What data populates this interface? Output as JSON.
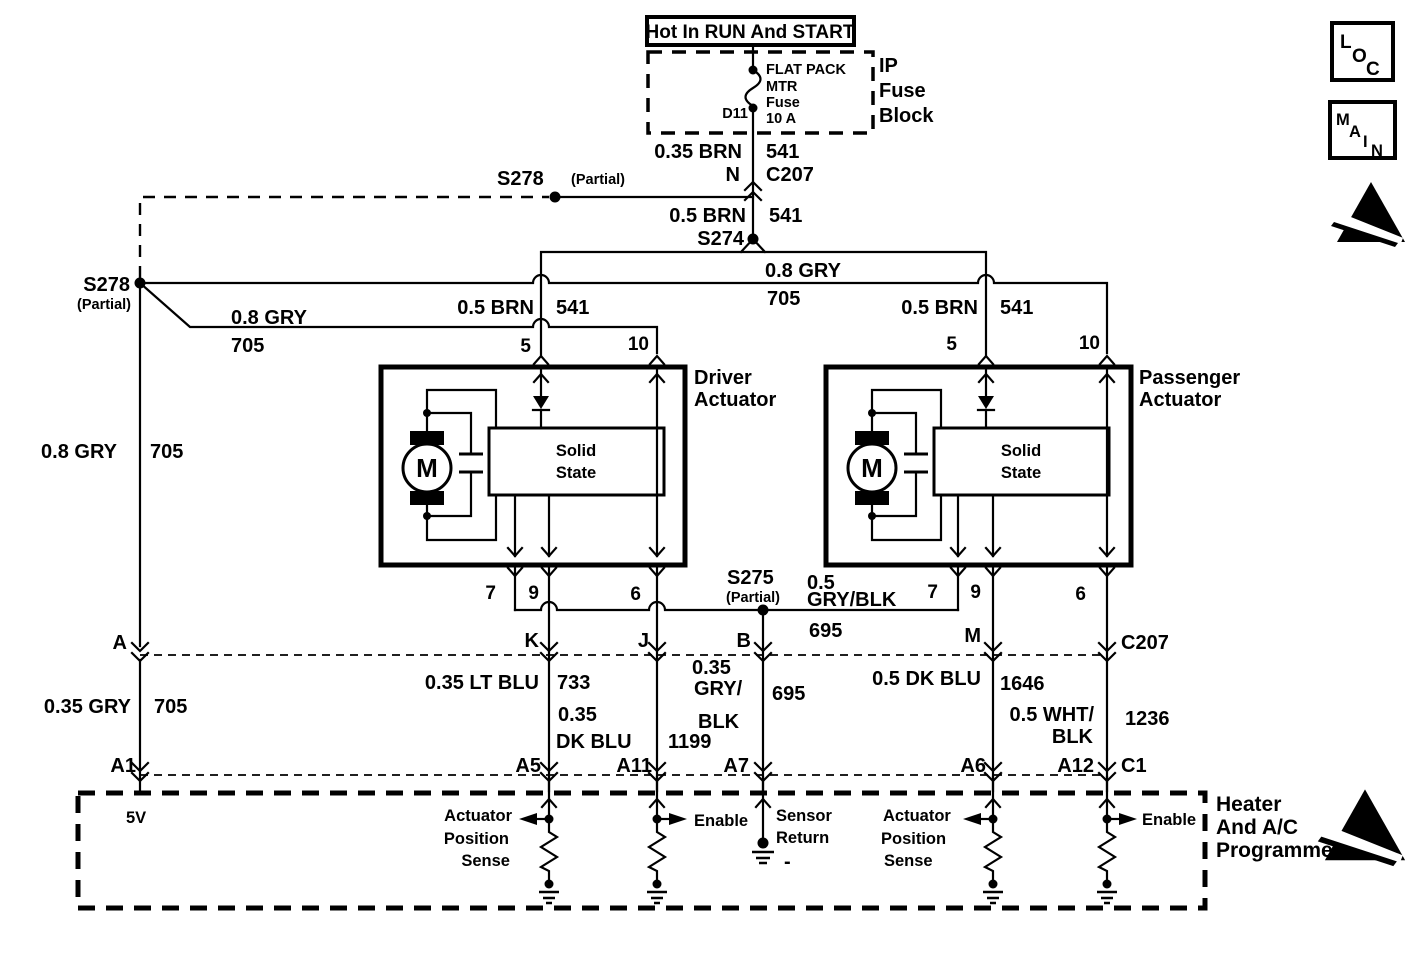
{
  "power": {
    "hot_label": "Hot In RUN And START",
    "fuse_name_1": "FLAT PACK",
    "fuse_name_2": "MTR",
    "fuse_name_3": "Fuse",
    "fuse_name_4": "10 A",
    "fuse_terminal": "D11",
    "block_name_1": "IP",
    "block_name_2": "Fuse",
    "block_name_3": "Block"
  },
  "corner_icons": {
    "loc_letters": [
      "L",
      "O",
      "C"
    ],
    "main_letters": [
      "M",
      "A",
      "I",
      "N"
    ]
  },
  "wires": {
    "fuse_output_color": "0.35 BRN",
    "fuse_output_terminal": "N",
    "fuse_output_circuit": "541",
    "fuse_output_connector": "C207",
    "feed_color": "0.5 BRN",
    "feed_circuit": "541",
    "gry_top_color": "0.8 GRY",
    "gry_top_circuit": "705",
    "gry_branch_color": "0.8 GRY",
    "gry_branch_circuit": "705",
    "brn_driver_color": "0.5 BRN",
    "brn_driver_circuit": "541",
    "brn_pass_color": "0.5 BRN",
    "brn_pass_circuit": "541",
    "gry_left_color": "0.8 GRY",
    "gry_left_circuit": "705",
    "gry_lower_color": "0.35 GRY",
    "gry_lower_circuit": "705",
    "bus_color_1": "0.5",
    "bus_color_2": "GRY/BLK",
    "bus_circuit": "695",
    "k_color": "0.35 LT BLU",
    "k_circuit": "733",
    "j_color_1": "0.35",
    "j_color_2": "DK BLU",
    "j_circuit": "1199",
    "b_color_1": "0.35",
    "b_color_2": "GRY/",
    "b_color_3": "BLK",
    "b_circuit": "695",
    "m_color": "0.5 DK BLU",
    "m_circuit": "1646",
    "right_color_1": "0.5 WHT/",
    "right_color_2": "BLK",
    "right_circuit": "1236"
  },
  "splices": {
    "s274": "S274",
    "s278_top_name": "S278",
    "s278_top_partial": "(Partial)",
    "s278_left_name": "S278",
    "s278_left_partial": "(Partial)",
    "s275_name": "S275",
    "s275_partial": "(Partial)"
  },
  "driver_actuator": {
    "name_1": "Driver",
    "name_2": "Actuator",
    "motor": "M",
    "solid_1": "Solid",
    "solid_2": "State",
    "pin_5": "5",
    "pin_10": "10",
    "pin_7": "7",
    "pin_9": "9",
    "pin_6": "6"
  },
  "passenger_actuator": {
    "name_1": "Passenger",
    "name_2": "Actuator",
    "motor": "M",
    "solid_1": "Solid",
    "solid_2": "State",
    "pin_5": "5",
    "pin_10": "10",
    "pin_7": "7",
    "pin_9": "9",
    "pin_6": "6"
  },
  "connector_row": {
    "t_a": "A",
    "t_k": "K",
    "t_j": "J",
    "t_b": "B",
    "t_m": "M",
    "name": "C207"
  },
  "programmer_row": {
    "t_a1": "A1",
    "t_a5": "A5",
    "t_a11": "A11",
    "t_a7": "A7",
    "t_a6": "A6",
    "t_a12": "A12",
    "name": "C1"
  },
  "programmer": {
    "name_1": "Heater",
    "name_2": "And A/C",
    "name_3": "Programmer",
    "ref": "5V",
    "drv_sense_1": "Actuator",
    "drv_sense_2": "Position",
    "drv_sense_3": "Sense",
    "drv_enable": "Enable",
    "ret_1": "Sensor",
    "ret_2": "Return",
    "ret_minus": "-",
    "pas_sense_1": "Actuator",
    "pas_sense_2": "Position",
    "pas_sense_3": "Sense",
    "pas_enable": "Enable"
  }
}
